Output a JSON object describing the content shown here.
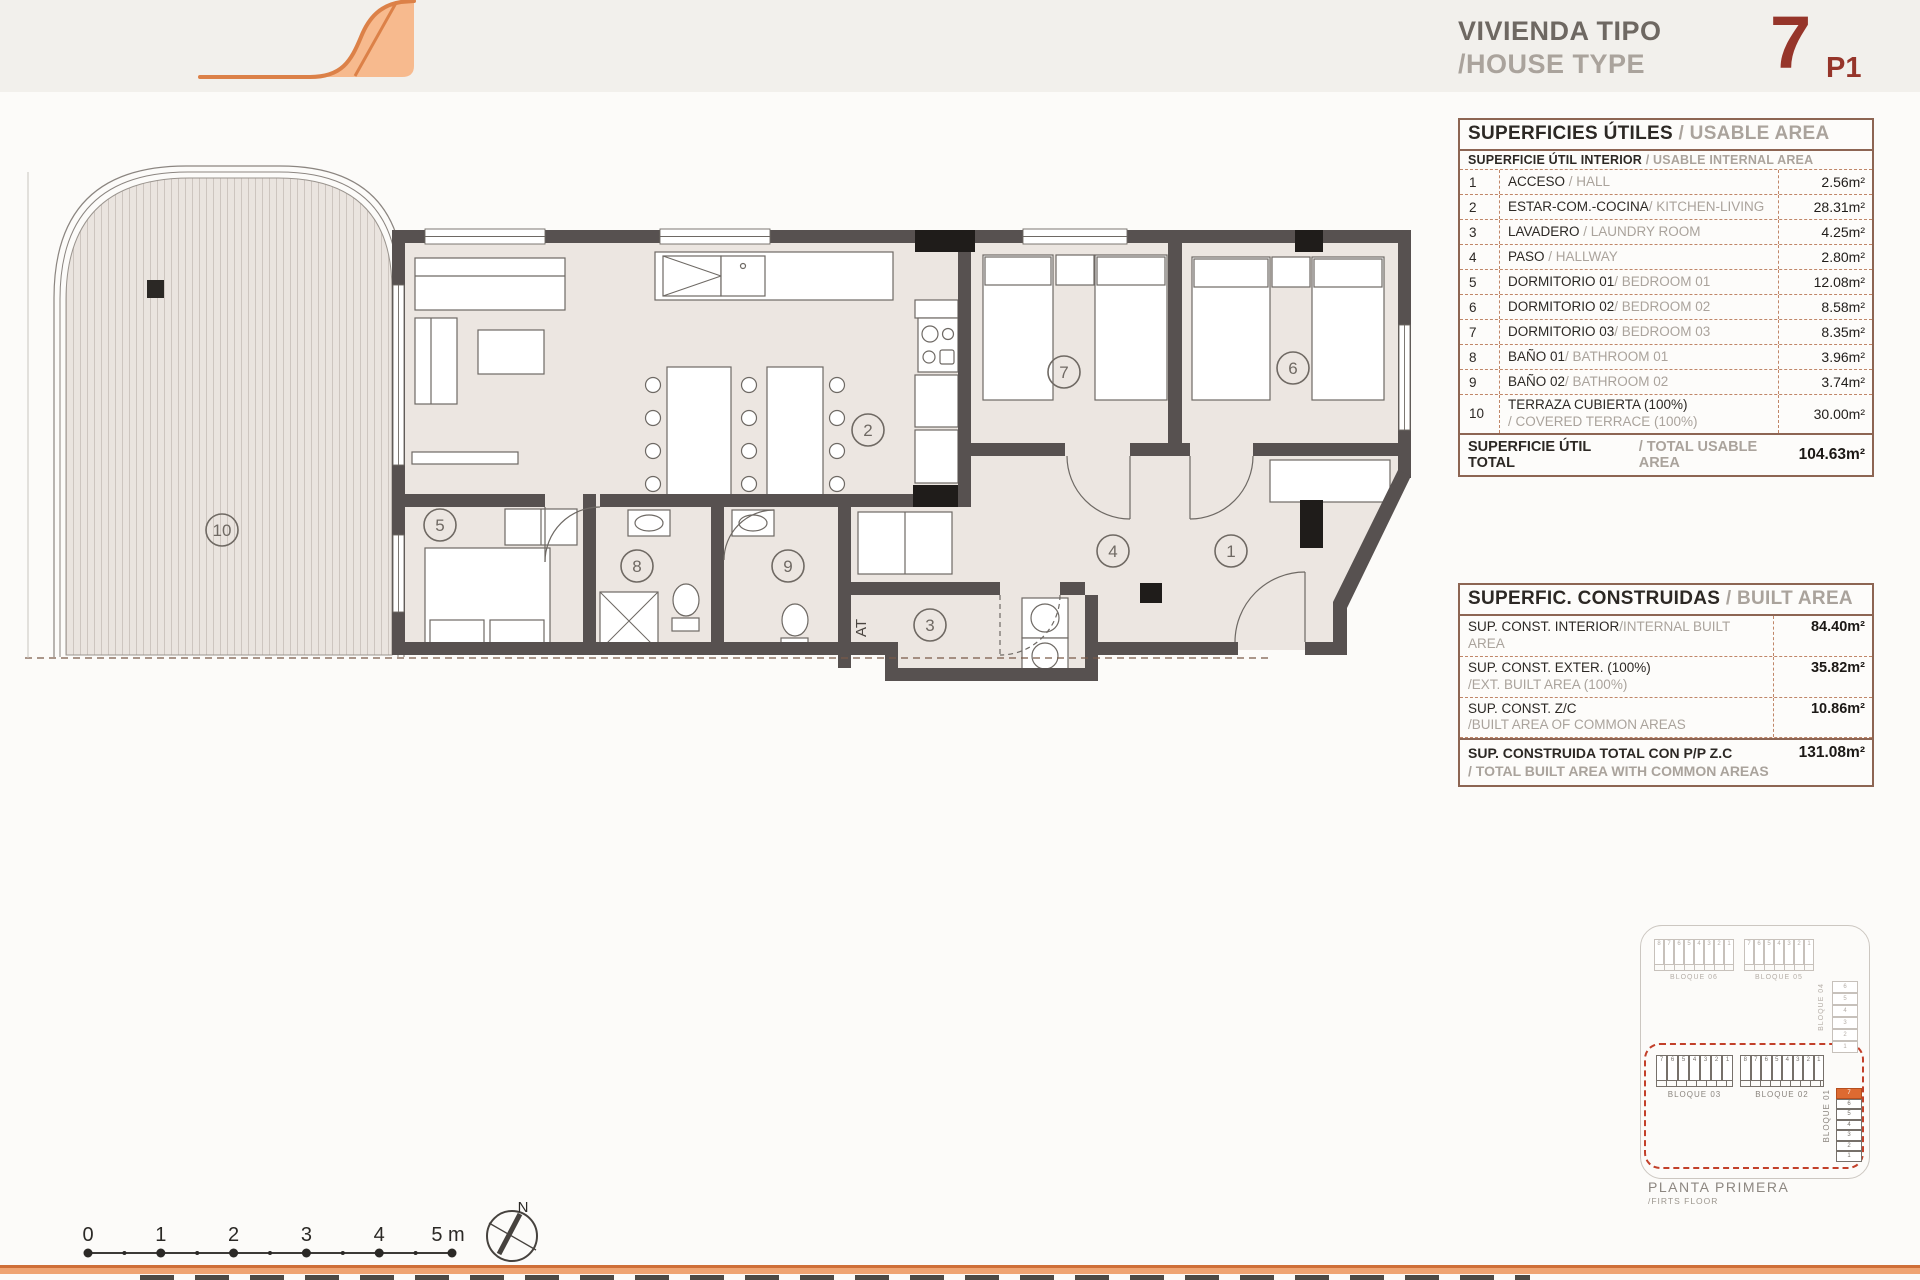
{
  "header": {
    "title_es": "VIVIENDA TIPO",
    "title_en": "/HOUSE TYPE",
    "type_number": "7",
    "floor_code": "P1"
  },
  "usable_table": {
    "title_es": "SUPERFICIES ÚTILES",
    "title_en": " / USABLE AREA",
    "subheader_es": "SUPERFICIE ÚTIL INTERIOR",
    "subheader_en": " / USABLE INTERNAL AREA",
    "rows": [
      {
        "num": "1",
        "name_es": "ACCESO",
        "name_en": " / HALL",
        "area": "2.56m²"
      },
      {
        "num": "2",
        "name_es": "ESTAR-COM.-COCINA",
        "name_en": "/ KITCHEN-LIVING",
        "area": "28.31m²"
      },
      {
        "num": "3",
        "name_es": "LAVADERO",
        "name_en": " / LAUNDRY ROOM",
        "area": "4.25m²"
      },
      {
        "num": "4",
        "name_es": "PASO",
        "name_en": " / HALLWAY",
        "area": "2.80m²"
      },
      {
        "num": "5",
        "name_es": "DORMITORIO 01",
        "name_en": "/ BEDROOM 01",
        "area": "12.08m²"
      },
      {
        "num": "6",
        "name_es": "DORMITORIO 02",
        "name_en": "/ BEDROOM 02",
        "area": "8.58m²"
      },
      {
        "num": "7",
        "name_es": "DORMITORIO 03",
        "name_en": "/ BEDROOM 03",
        "area": "8.35m²"
      },
      {
        "num": "8",
        "name_es": "BAÑO 01",
        "name_en": "/ BATHROOM 01",
        "area": "3.96m²"
      },
      {
        "num": "9",
        "name_es": "BAÑO 02",
        "name_en": "/ BATHROOM 02",
        "area": "3.74m²"
      },
      {
        "num": "10",
        "name_es": "TERRAZA CUBIERTA (100%)",
        "name_en": "/ COVERED TERRACE (100%)",
        "area": "30.00m²"
      }
    ],
    "total_label_es": "SUPERFICIE ÚTIL TOTAL",
    "total_label_en": " / TOTAL USABLE AREA",
    "total_value": "104.63m²"
  },
  "built_table": {
    "title_es": "SUPERFIC. CONSTRUIDAS",
    "title_en": " / BUILT AREA",
    "rows": [
      {
        "label_es": "SUP. CONST. INTERIOR",
        "label_en": "/INTERNAL BUILT AREA",
        "value": "84.40m²"
      },
      {
        "label_es": "SUP. CONST. EXTER. (100%)",
        "label_en": "/EXT. BUILT AREA (100%)",
        "value": "35.82m²"
      },
      {
        "label_es": "SUP. CONST. Z/C",
        "label_en": "/BUILT AREA OF COMMON AREAS",
        "value": "10.86m²"
      }
    ],
    "total_label_es": "SUP. CONSTRUIDA TOTAL CON P/P Z.C",
    "total_label_en": "/ TOTAL BUILT AREA WITH COMMON AREAS",
    "total_value": "131.08m²"
  },
  "site_plan": {
    "caption_es": "PLANTA PRIMERA",
    "caption_en": "/FIRTS FLOOR",
    "b06": {
      "label": "BLOQUE 06",
      "cells": [
        "8",
        "7",
        "6",
        "5",
        "4",
        "3",
        "2",
        "1"
      ]
    },
    "b05": {
      "label": "BLOQUE 05",
      "cells": [
        "7",
        "6",
        "5",
        "4",
        "3",
        "2",
        "1"
      ]
    },
    "b04": {
      "label": "BLOQUE 04",
      "cells": [
        "6",
        "5",
        "4",
        "3",
        "2",
        "1"
      ]
    },
    "b03": {
      "label": "BLOQUE 03",
      "cells": [
        "7",
        "6",
        "5",
        "4",
        "3",
        "2",
        "1"
      ]
    },
    "b02": {
      "label": "BLOQUE 02",
      "cells": [
        "8",
        "7",
        "6",
        "5",
        "4",
        "3",
        "2",
        "1"
      ]
    },
    "b01": {
      "label": "BLOQUE 01",
      "cells": [
        {
          "n": "7",
          "hl": true
        },
        {
          "n": "6"
        },
        {
          "n": "5"
        },
        {
          "n": "4"
        },
        {
          "n": "3"
        },
        {
          "n": "2"
        },
        {
          "n": "1"
        }
      ]
    }
  },
  "floor_plan": {
    "rooms": {
      "r1": "1",
      "r2": "2",
      "r3": "3",
      "r4": "4",
      "r5": "5",
      "r6": "6",
      "r7": "7",
      "r8": "8",
      "r9": "9",
      "r10": "10"
    },
    "at_label": "AT"
  },
  "scale_bar": {
    "labels": [
      "0",
      "1",
      "2",
      "3",
      "4",
      "5 m"
    ]
  },
  "compass": {
    "label": "N"
  }
}
